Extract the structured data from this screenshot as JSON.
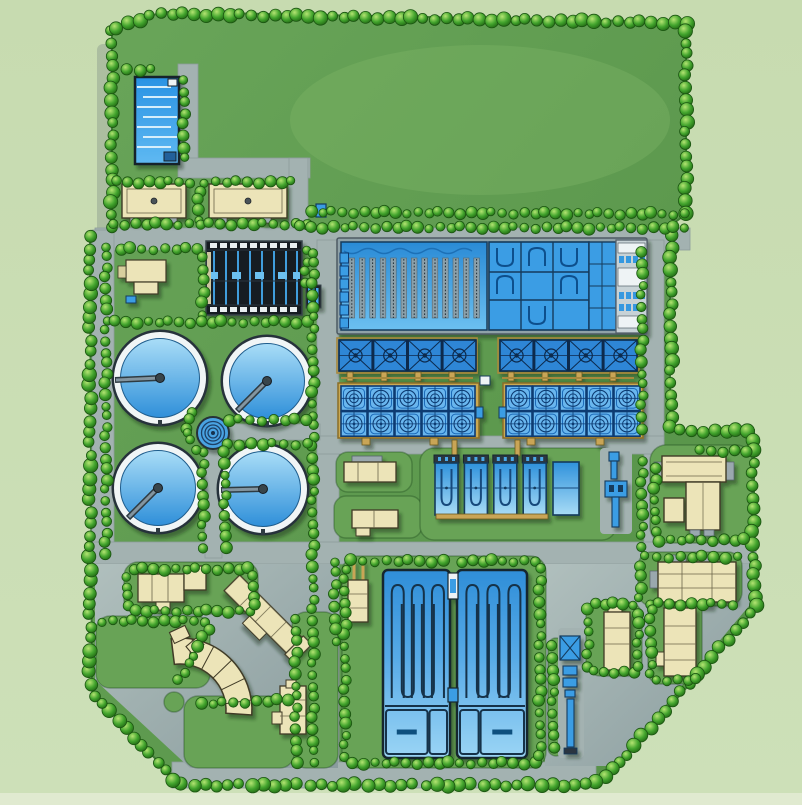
{
  "meta": {
    "subject": "Wastewater treatment plant aerial site plan",
    "plan_type": "site-plan rendering, top-down view",
    "width": 802,
    "height": 805
  },
  "palette": {
    "outside_green": "#c9dcb2",
    "site_green": "#609a4f",
    "island_green": "#68a356",
    "road_gray": "#a3b2b1",
    "plaza_gray": "#9dadab",
    "tree_green": "#3fa32c",
    "tree_edge": "#1b5511",
    "water_light": "#a9ddf7",
    "water_deep": "#2f8fd9",
    "cell_blue": "#3aa0ee",
    "deep_navy": "#0d3b72",
    "building_beige": "#ece4b8",
    "building_edge": "#3f3a26",
    "dark_structure": "#171b20",
    "white_trim": "#eef3f5",
    "pipe_tan": "#c9a557"
  },
  "facilities": {
    "plan_title": "Wastewater treatment plant site plan",
    "north_basin": "Inclined sludge drying beds",
    "north_building_west": "North outbuilding west",
    "north_building_east": "North outbuilding east",
    "covered_tanks": "Covered primary tank block",
    "chem_outbuilding": "Small chemical outbuilding",
    "clarifiers": "Secondary clarifier tanks",
    "distribution_chamber": "Central distribution chamber",
    "aeration": "Aeration basin complex",
    "blower_building": "Blower and control building",
    "filter_banks": "Covered filter cell banks",
    "gallery_blocks": "Filter gallery cell blocks",
    "uv_channels": "Disinfection channels",
    "side_tank": "Equalization tank",
    "equipment_line": "Sludge handling equipment line",
    "t_building": "Process building",
    "workshop": "Maintenance workshop",
    "contact_basins": "Serpentine contact basins",
    "admin_building": "Administration building",
    "diagonal_building": "Laboratory building",
    "crescent_building": "Curved office building",
    "strip_building": "Garage building",
    "building_e": "Pump station",
    "building_f": "Storage building",
    "conveyor": "Sludge conveyor line",
    "roundabout": "Roundabout island"
  }
}
